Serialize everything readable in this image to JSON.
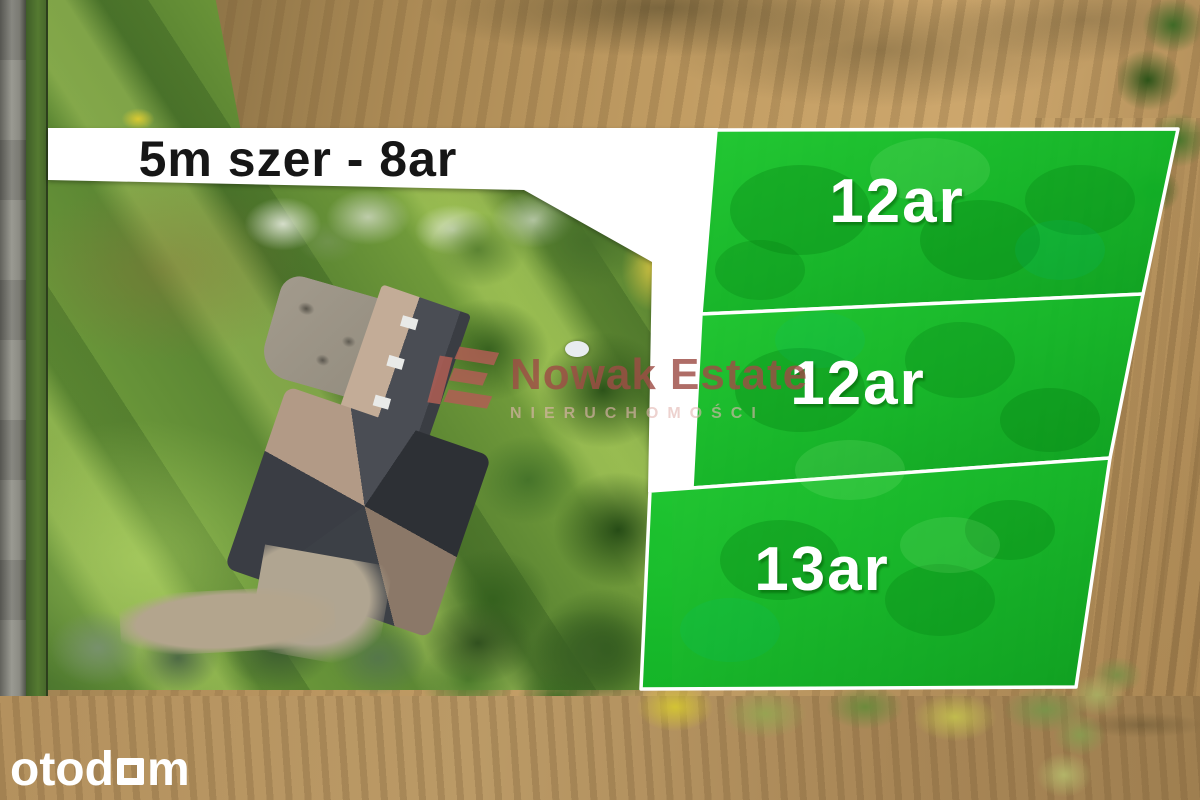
{
  "scene": {
    "description": "Aerial drone photo of a rural property; three highlighted building plots for sale on the right, house with garden on the left"
  },
  "banner": {
    "text": "5m szer - 8ar",
    "background": "#ffffff",
    "text_color": "#161616"
  },
  "plots": {
    "fill": "#12b728",
    "border": "#ffffff",
    "label_color": "#ffffff",
    "items": [
      {
        "label": "12ar"
      },
      {
        "label": "12ar"
      },
      {
        "label": "13ar"
      }
    ]
  },
  "watermark": {
    "name": "Nowak Estate",
    "subtitle": "NIERUCHOMOŚCI",
    "color": "#a55a52"
  },
  "site_logo": {
    "prefix": "otod",
    "suffix": "m",
    "glyph": "square-outline-o",
    "color": "#ffffff"
  }
}
